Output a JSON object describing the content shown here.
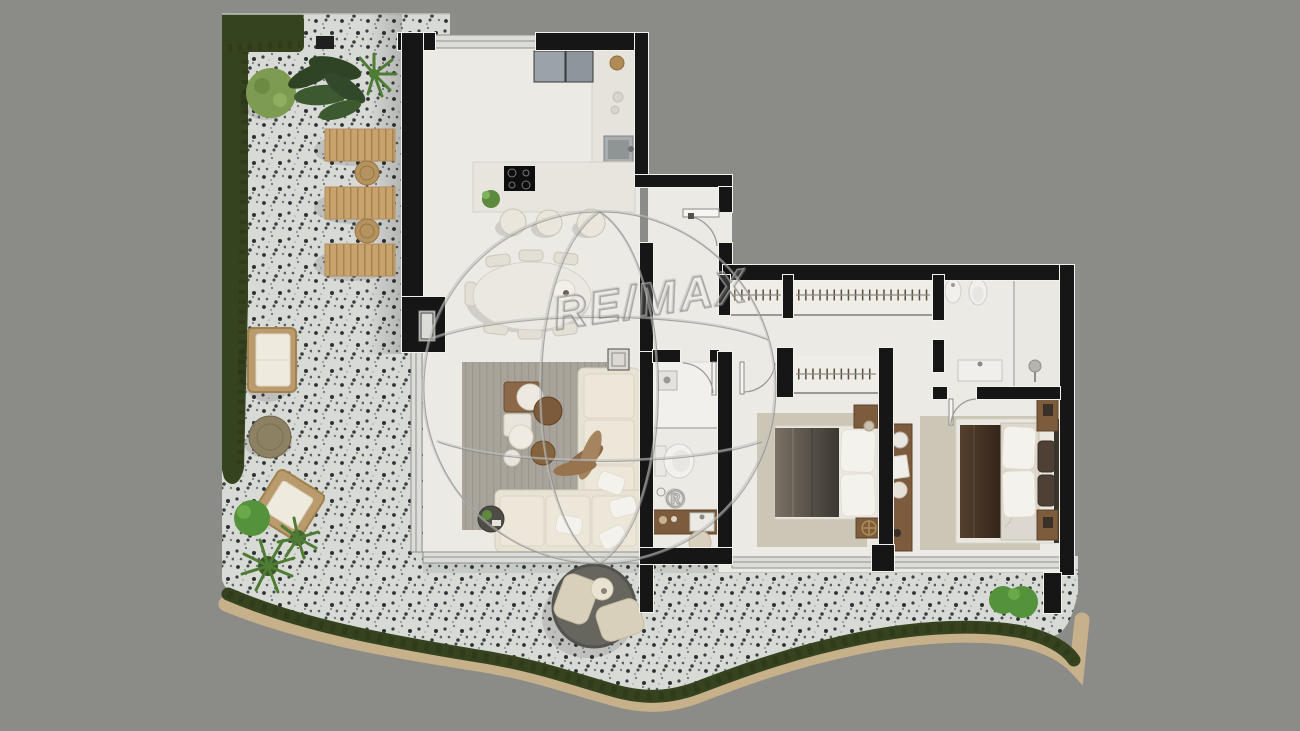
{
  "scene": {
    "type": "floor-plan-render",
    "description": "Top-down 3D rendering of a two-bedroom apartment with an L-shaped wrap-around terrazzo terrace, hedges and outdoor furniture"
  },
  "watermark": {
    "brand": "RE/MAX",
    "registered": "®"
  },
  "colors": {
    "background": "#8b8b88",
    "terrace": "#d8dad6",
    "wall": "#161616",
    "wall-edge": "#f2f2ef",
    "floor": "#eceae5",
    "glass": "#dcdcd8",
    "hedge": "#36431f",
    "shrub": "#55923c",
    "palm": "#4f7c34",
    "moss": "#7d9c52",
    "sand": "#c7b18a",
    "lounger-wood": "#c9a36e",
    "wicker": "#b99b6e",
    "cushion": "#efeade",
    "rug-living": "#a8a49b",
    "rug-bedroom": "#ccc6b7",
    "sofa": "#e7e2d4",
    "wood": "#7c5c3d",
    "bed-throw-dark": "#3b3831",
    "bed-throw-brown": "#42301f",
    "duvet": "#dcd8cf",
    "appliance": "#9aa2aa",
    "cooktop": "#0e0e0e",
    "daybed": "#66665f"
  },
  "rooms": [
    {
      "name": "Kitchen",
      "items": [
        "fridge-freezer",
        "counter",
        "sink",
        "kitchen-island",
        "induction-cooktop",
        "bar-stool x3",
        "potted-plant",
        "brass-bowl"
      ]
    },
    {
      "name": "Dining area",
      "items": [
        "oval-dining-table",
        "dining-chair x7",
        "decor-bowl"
      ]
    },
    {
      "name": "Living room",
      "items": [
        "corner-sofa",
        "coffee-table-set",
        "side-table",
        "dried-plant",
        "tray-table",
        "area-rug",
        "throw-pillows"
      ]
    },
    {
      "name": "Entrance hall",
      "items": [
        "entry-door"
      ]
    },
    {
      "name": "Bathroom",
      "items": [
        "walk-in-shower",
        "toilet",
        "wood-vanity",
        "washbasin",
        "stool",
        "floor-drain"
      ]
    },
    {
      "name": "Hallway",
      "items": [
        "wardrobe x2"
      ]
    },
    {
      "name": "Bedroom 2",
      "items": [
        "double-bed",
        "nightstand x2",
        "wardrobe",
        "area-rug",
        "table-lamp x2"
      ]
    },
    {
      "name": "Master bathroom",
      "items": [
        "toilet",
        "bidet",
        "walk-in-shower",
        "washbasin-vanity",
        "glass-partition"
      ]
    },
    {
      "name": "Master bedroom",
      "items": [
        "double-bed",
        "nightstand x2",
        "console-desk",
        "mirror",
        "area-rug"
      ]
    },
    {
      "name": "Terrace",
      "items": [
        "sun-lounger x3",
        "side-table x2",
        "outdoor-sofa",
        "round-coffee-table",
        "outdoor-armchair",
        "round-daybed",
        "perimeter-hedge",
        "shrub x4",
        "palm x3",
        "moss-bush"
      ]
    }
  ]
}
